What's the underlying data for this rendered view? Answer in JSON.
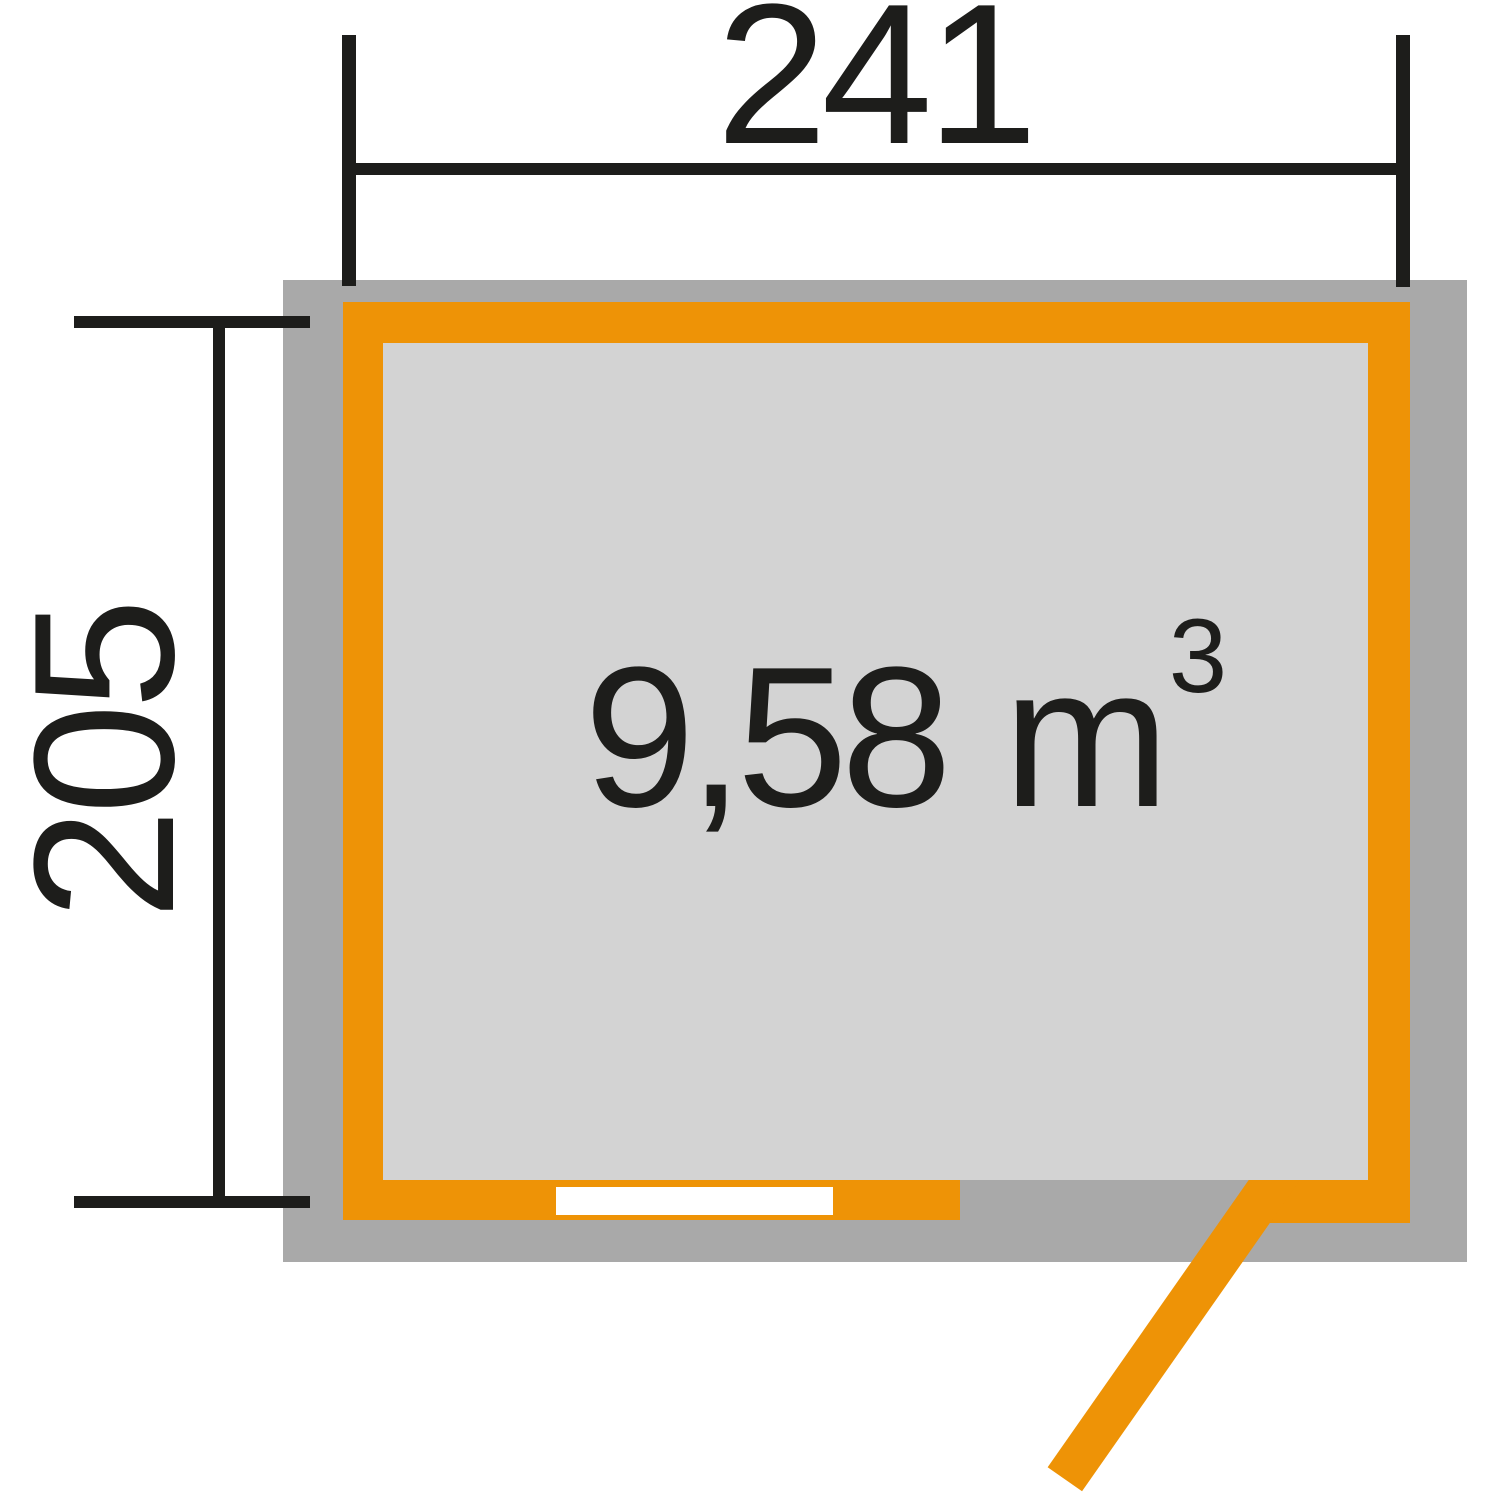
{
  "dimension_labels": {
    "width": "241",
    "depth": "205"
  },
  "volume_label": {
    "value": "9,58",
    "unit": "m",
    "exponent": "3"
  },
  "colors": {
    "wall_orange": "#ee9306",
    "roof_overhang_gray": "#a9a9a9",
    "floor_gray": "#d3d3d3",
    "dimension_line_black": "#1d1d1b",
    "window_white": "#ffffff",
    "background": "#ffffff"
  }
}
